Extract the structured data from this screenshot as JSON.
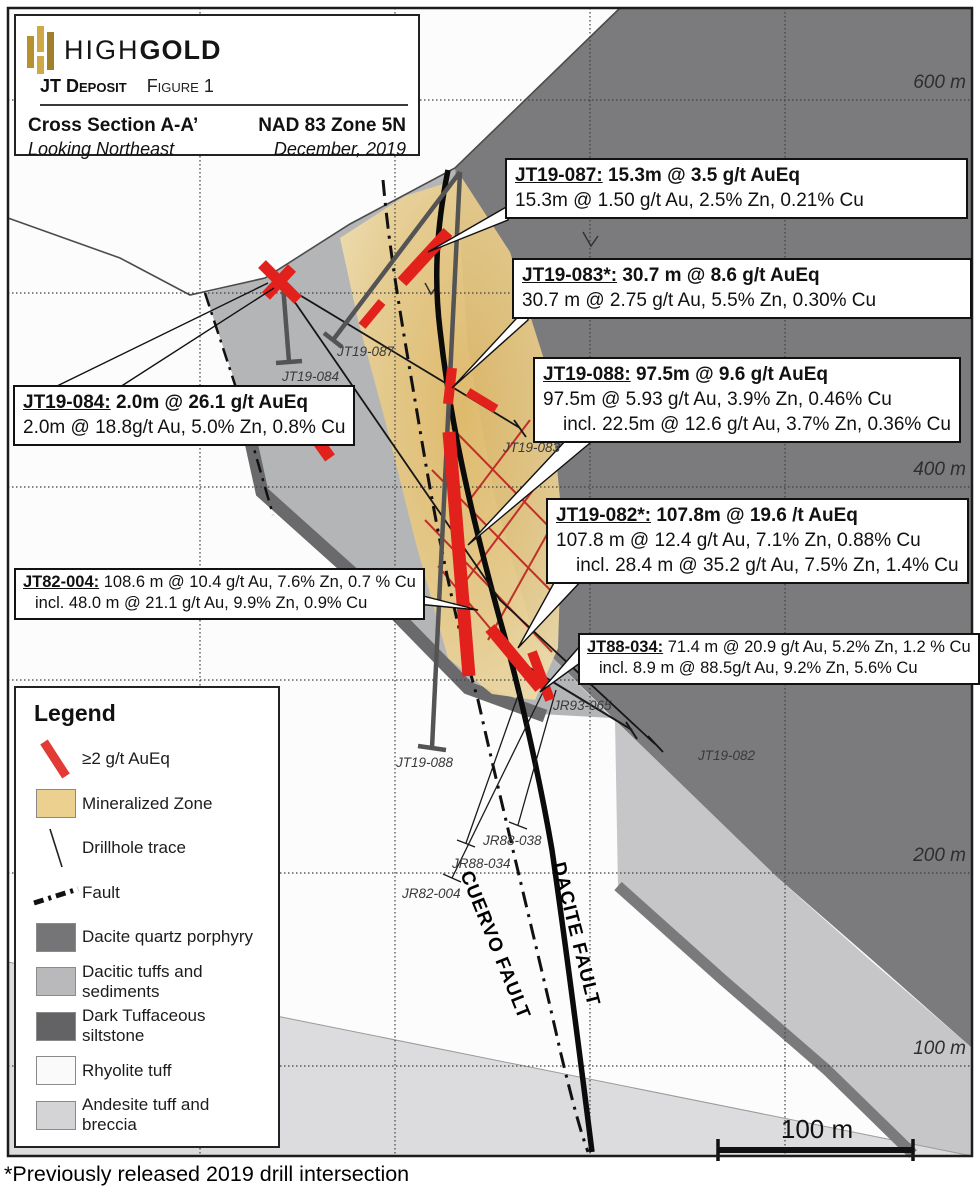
{
  "title_box": {
    "brand_high": "HIGH",
    "brand_gold": "GOLD",
    "deposit": "JT Deposit",
    "figure": "Figure 1",
    "section": "Cross Section A-A’",
    "looking": "Looking Northeast",
    "datum": "NAD 83 Zone 5N",
    "date": "December, 2019"
  },
  "callouts": [
    {
      "id": "JT19-087:",
      "head": " 15.3m @ 3.5 g/t AuEq",
      "line2": "15.3m @ 1.50 g/t Au, 2.5% Zn, 0.21% Cu"
    },
    {
      "id": "JT19-083*:",
      "head": " 30.7 m @ 8.6 g/t AuEq",
      "line2": "30.7 m @ 2.75 g/t Au, 5.5% Zn, 0.30% Cu"
    },
    {
      "id": "JT19-088:",
      "head": " 97.5m @ 9.6 g/t AuEq",
      "line2": "97.5m @ 5.93 g/t Au, 3.9% Zn, 0.46% Cu",
      "line3": "incl.  22.5m @ 12.6 g/t Au, 3.7% Zn, 0.36% Cu"
    },
    {
      "id": "JT19-082*:",
      "head": " 107.8m @ 19.6 /t AuEq",
      "line2": "107.8 m @ 12.4 g/t Au, 7.1% Zn, 0.88% Cu",
      "line3": "incl. 28.4 m @ 35.2 g/t Au, 7.5% Zn, 1.4% Cu"
    },
    {
      "id": "JT19-084:",
      "head": " 2.0m @ 26.1 g/t AuEq",
      "line2": "2.0m @ 18.8g/t Au, 5.0% Zn, 0.8% Cu"
    },
    {
      "id": "JT82-004:",
      "head": " 108.6 m @ 10.4 g/t Au, 7.6% Zn, 0.7 % Cu",
      "line2": "incl. 48.0 m @ 21.1 g/t Au, 9.9% Zn, 0.9% Cu"
    },
    {
      "id": "JT88-034:",
      "head": " 71.4 m @ 20.9 g/t Au, 5.2% Zn, 1.2 % Cu",
      "line2": "incl. 8.9 m @ 88.5g/t Au, 9.2% Zn, 5.6% Cu"
    }
  ],
  "legend": {
    "title": "Legend",
    "items": [
      {
        "label": "≥2 g/t AuEq",
        "type": "red-intercept-line",
        "color": "#e23b36"
      },
      {
        "label": "Mineralized Zone",
        "type": "swatch",
        "color": "#ecd08f"
      },
      {
        "label": "Drillhole trace",
        "type": "thin-line",
        "color": "#222222"
      },
      {
        "label": "Fault",
        "type": "dash-dot-line",
        "color": "#111111"
      },
      {
        "label": "Dacite quartz porphyry",
        "type": "swatch",
        "color": "#757577"
      },
      {
        "label": "Dacitic tuffs and sediments",
        "type": "swatch",
        "color": "#b9b9bb"
      },
      {
        "label": "Dark Tuffaceous siltstone",
        "type": "swatch",
        "color": "#636366"
      },
      {
        "label": "Rhyolite tuff",
        "type": "swatch",
        "color": "#fafafa"
      },
      {
        "label": "Andesite tuff and breccia",
        "type": "swatch",
        "color": "#d4d4d6"
      }
    ]
  },
  "elevation_labels": [
    "600 m",
    "500 m",
    "400 m",
    "300 m",
    "200 m",
    "100 m"
  ],
  "drill_labels": [
    "JT19-087",
    "JT19-084",
    "JT19-083",
    "JT19-088",
    "JR93-065",
    "JT19-082",
    "JR88-038",
    "JR88-034",
    "JR82-004"
  ],
  "fault_labels": {
    "cuervo": "CUERVO FAULT",
    "dacite": "DACITE FAULT"
  },
  "scale_bar": {
    "label": "100 m"
  },
  "footnote": "*Previously released 2019 drill intersection",
  "colors": {
    "intercept_red": "#e3211c",
    "mineralized_tan": "#ecd08f",
    "dacite_porphyry": "#7b7b7d",
    "dacitic_tuffs": "#b4b5b7",
    "dark_siltstone": "#6a6a6c",
    "rhyolite": "#fcfcfc",
    "andesite": "#d9d9db",
    "logo_gold": "#c6a03c"
  }
}
